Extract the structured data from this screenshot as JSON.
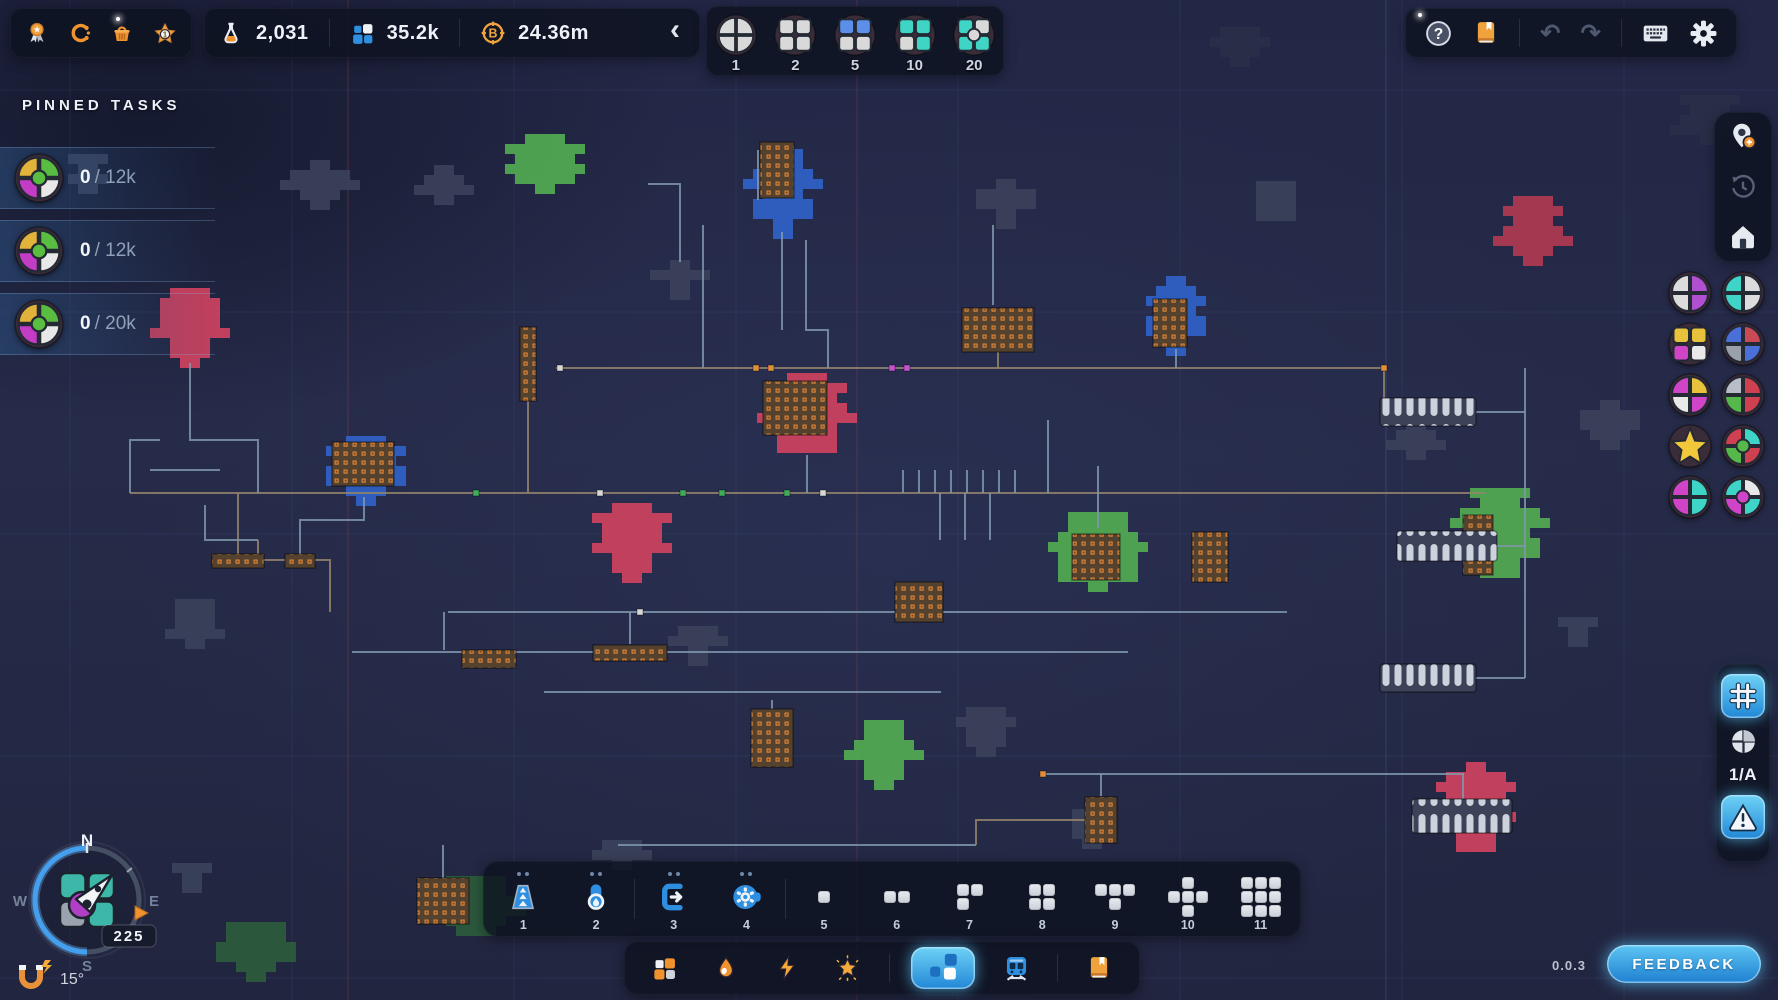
{
  "app": {
    "version": "0.0.3",
    "feedback_label": "FEEDBACK"
  },
  "topbar": {
    "left_menu": {
      "badge_value": "1"
    },
    "resources": [
      {
        "name": "research",
        "value": "2,031"
      },
      {
        "name": "shapes",
        "value": "35.2k"
      },
      {
        "name": "currency",
        "value": "24.36m"
      }
    ],
    "collapse_icon": "‹",
    "throughput_selector": {
      "options": [
        {
          "label": "1"
        },
        {
          "label": "2"
        },
        {
          "label": "5"
        },
        {
          "label": "10"
        },
        {
          "label": "20"
        }
      ]
    },
    "right_menu": {
      "help": "?",
      "undo": "↶",
      "redo": "↷"
    }
  },
  "pinned_tasks": {
    "title": "PINNED TASKS",
    "tasks": [
      {
        "current": "0",
        "sep": "/",
        "target": "12k"
      },
      {
        "current": "0",
        "sep": "/",
        "target": "12k"
      },
      {
        "current": "0",
        "sep": "/",
        "target": "20k"
      }
    ]
  },
  "sidebar_right": {
    "zone_label": "1/A"
  },
  "toolbar": {
    "items": [
      {
        "label": "1",
        "icon": "belt-icon",
        "pips": 2
      },
      {
        "label": "2",
        "icon": "pipe-icon",
        "pips": 2
      },
      {
        "label": "3",
        "icon": "extractor-icon",
        "pips": 2
      },
      {
        "label": "4",
        "icon": "processor-icon",
        "pips": 2
      },
      {
        "label": "5",
        "grid": [
          "1"
        ]
      },
      {
        "label": "6",
        "grid": [
          "11"
        ]
      },
      {
        "label": "7",
        "grid": [
          "11",
          "10"
        ]
      },
      {
        "label": "8",
        "grid": [
          "11",
          "11"
        ]
      },
      {
        "label": "9",
        "grid": [
          "111",
          "010"
        ]
      },
      {
        "label": "10",
        "grid": [
          "010",
          "111",
          "010"
        ]
      },
      {
        "label": "11",
        "grid": [
          "111",
          "111",
          "111"
        ]
      }
    ]
  },
  "compass": {
    "north": "N",
    "south": "S",
    "west": "W",
    "east": "E",
    "heading": "225",
    "tilt": "15°"
  },
  "badges": {
    "task_icon": {
      "shape": "circle",
      "colors": [
        "#e2b33a",
        "#58bd41",
        "#c33cc6",
        "#e8e8e8"
      ],
      "inner": "#58bd41"
    },
    "selector": [
      {
        "shape": "circle",
        "colors": [
          "#d9d9d9",
          "#d9d9d9",
          "#d9d9d9",
          "#d9d9d9"
        ]
      },
      {
        "shape": "square",
        "colors": [
          "#d9d9d9",
          "#d9d9d9",
          "#d9d9d9",
          "#d9d9d9"
        ]
      },
      {
        "shape": "square",
        "colors": [
          "#5b8fe8",
          "#5b8fe8",
          "#d9d9d9",
          "#d9d9d9"
        ]
      },
      {
        "shape": "square",
        "colors": [
          "#3fd4c4",
          "#3fd4c4",
          "#d9d9d9",
          "#3fd4c4"
        ]
      },
      {
        "shape": "square",
        "colors": [
          "#3fd4c4",
          "#d9d9d9",
          "#3fd4c4",
          "#3fd4c4"
        ],
        "inner": "#d9d9d9"
      }
    ],
    "sidebar": [
      {
        "shape": "circle",
        "colors": [
          "#dcdcdc",
          "#b04fd0",
          "#dcdcdc",
          "#b04fd0"
        ]
      },
      {
        "shape": "circle",
        "colors": [
          "#3fd4c8",
          "#dcdcdc",
          "#3fd4c8",
          "#dcdcdc"
        ]
      },
      {
        "shape": "square",
        "colors": [
          "#e8c23a",
          "#e8c23a",
          "#d045c8",
          "#e8e8e8"
        ]
      },
      {
        "shape": "circle",
        "colors": [
          "#4a6fd8",
          "#c84a55",
          "#9aa0aa",
          "#4a6fd8"
        ]
      },
      {
        "shape": "circle",
        "colors": [
          "#d045c8",
          "#e8c23a",
          "#e8e8e8",
          "#d045c8"
        ]
      },
      {
        "shape": "circle",
        "colors": [
          "#b8bec8",
          "#cf4050",
          "#56b84a",
          "#cf4050"
        ]
      },
      {
        "shape": "star",
        "colors": [
          "#f0c83a"
        ]
      },
      {
        "shape": "circle",
        "colors": [
          "#cf4050",
          "#3fd4c8",
          "#56b84a",
          "#cf4050"
        ],
        "inner": "#56b84a"
      },
      {
        "shape": "circle",
        "colors": [
          "#d045c8",
          "#3fd4c8",
          "#d045c8",
          "#3fd4c8"
        ]
      },
      {
        "shape": "circle",
        "colors": [
          "#3fd4c8",
          "#e8e8e8",
          "#d045c8",
          "#3fd4c8"
        ],
        "inner": "#d045c8"
      }
    ]
  },
  "map": {
    "colors": {
      "g": "#53ab53",
      "gd": "#2c5c3c",
      "c": "#ce4260",
      "cd": "#b03a52",
      "b": "#2f62c8",
      "y": "#3b415a",
      "dk": "#2a2f49",
      "steel": "#7f96ab",
      "tan": "#94846b"
    },
    "blobs": [
      [
        545,
        160,
        38,
        26,
        "g"
      ],
      [
        1098,
        552,
        44,
        40,
        "g"
      ],
      [
        1500,
        532,
        42,
        44,
        "g"
      ],
      [
        884,
        753,
        30,
        33,
        "g"
      ],
      [
        476,
        906,
        40,
        30,
        "gd"
      ],
      [
        256,
        948,
        36,
        26,
        "gd"
      ],
      [
        190,
        325,
        34,
        37,
        "c"
      ],
      [
        807,
        413,
        42,
        40,
        "c"
      ],
      [
        632,
        540,
        35,
        37,
        "c"
      ],
      [
        1476,
        806,
        35,
        44,
        "c"
      ],
      [
        1533,
        230,
        31,
        34,
        "cd"
      ],
      [
        783,
        190,
        31,
        41,
        "b"
      ],
      [
        1176,
        313,
        29,
        37,
        "b"
      ],
      [
        366,
        467,
        39,
        31,
        "b"
      ],
      [
        320,
        183,
        29,
        23,
        "y"
      ],
      [
        444,
        184,
        23,
        19,
        "y"
      ],
      [
        680,
        277,
        21,
        17,
        "y"
      ],
      [
        1006,
        200,
        27,
        21,
        "y"
      ],
      [
        1276,
        200,
        25,
        19,
        "y"
      ],
      [
        195,
        620,
        25,
        21,
        "y"
      ],
      [
        698,
        645,
        23,
        19,
        "y"
      ],
      [
        986,
        728,
        25,
        21,
        "y"
      ],
      [
        1610,
        423,
        27,
        23,
        "y"
      ],
      [
        1416,
        437,
        21,
        17,
        "y"
      ],
      [
        1092,
        826,
        23,
        17,
        "y"
      ],
      [
        192,
        876,
        17,
        13,
        "y"
      ],
      [
        622,
        855,
        21,
        15,
        "y"
      ],
      [
        88,
        170,
        20,
        16,
        "y"
      ],
      [
        1578,
        628,
        14,
        11,
        "y"
      ],
      [
        1710,
        120,
        31,
        25,
        "dk"
      ],
      [
        1240,
        45,
        25,
        18,
        "dk"
      ]
    ],
    "machines": [
      [
        777,
        170,
        34,
        56
      ],
      [
        998,
        330,
        72,
        44
      ],
      [
        1170,
        323,
        34,
        48
      ],
      [
        363,
        464,
        62,
        44
      ],
      [
        795,
        408,
        64,
        54
      ],
      [
        528,
        364,
        16,
        74
      ],
      [
        919,
        602,
        48,
        40
      ],
      [
        1096,
        557,
        48,
        46
      ],
      [
        1210,
        557,
        36,
        50
      ],
      [
        772,
        738,
        42,
        58
      ],
      [
        1101,
        820,
        32,
        46
      ],
      [
        630,
        653,
        74,
        16
      ],
      [
        489,
        659,
        54,
        18
      ],
      [
        443,
        901,
        52,
        46
      ],
      [
        1478,
        545,
        30,
        60
      ],
      [
        238,
        561,
        52,
        14
      ],
      [
        300,
        561,
        30,
        14
      ]
    ],
    "pill_rows": [
      [
        1428,
        412,
        96,
        28
      ],
      [
        1447,
        546,
        100,
        30
      ],
      [
        1428,
        678,
        96,
        28
      ],
      [
        1462,
        816,
        100,
        34
      ]
    ],
    "lines": [
      {
        "c": "t",
        "d": "M556,368 H1384"
      },
      {
        "c": "t",
        "d": "M130,493 H1486"
      },
      {
        "c": "s",
        "d": "M448,612 H1287"
      },
      {
        "c": "s",
        "d": "M352,652 H1128"
      },
      {
        "c": "s",
        "d": "M544,692 H941"
      },
      {
        "c": "s",
        "d": "M1043,774 H1464"
      },
      {
        "c": "s",
        "d": "M618,845 H976"
      },
      {
        "c": "s",
        "d": "M703,225 V368"
      },
      {
        "c": "s",
        "d": "M758,150 V200"
      },
      {
        "c": "s",
        "d": "M782,232 V330"
      },
      {
        "c": "s",
        "d": "M806,240 V330 H828 V368"
      },
      {
        "c": "s",
        "d": "M648,184 H680 V262"
      },
      {
        "c": "s",
        "d": "M993,225 V305"
      },
      {
        "c": "t",
        "d": "M998,352 V368"
      },
      {
        "c": "s",
        "d": "M1176,349 V368"
      },
      {
        "c": "s",
        "d": "M1048,420 V493"
      },
      {
        "c": "s",
        "d": "M1098,466 V528"
      },
      {
        "c": "s",
        "d": "M807,455 V493"
      },
      {
        "c": "t",
        "d": "M528,401 V493"
      },
      {
        "c": "s",
        "d": "M364,497 V520 H300 V560"
      },
      {
        "c": "s",
        "d": "M190,363 V440 H258 V493"
      },
      {
        "c": "t",
        "d": "M238,493 V560 H330 V612"
      },
      {
        "c": "s",
        "d": "M160,440 H130 V493"
      },
      {
        "c": "s",
        "d": "M444,612 V650"
      },
      {
        "c": "s",
        "d": "M630,612 V644"
      },
      {
        "c": "s",
        "d": "M919,612 V622"
      },
      {
        "c": "s",
        "d": "M772,700 V710"
      },
      {
        "c": "s",
        "d": "M1101,774 V796"
      },
      {
        "c": "s",
        "d": "M1525,368 V678"
      },
      {
        "c": "s",
        "d": "M1476,412 H1525"
      },
      {
        "c": "s",
        "d": "M1497,546 H1525"
      },
      {
        "c": "s",
        "d": "M1476,678 H1525"
      },
      {
        "c": "s",
        "d": "M1463,774 V800"
      },
      {
        "c": "t",
        "d": "M1384,368 V412 H1476"
      },
      {
        "c": "s",
        "d": "M443,845 V878"
      },
      {
        "c": "t",
        "d": "M976,845 V820 H1086"
      },
      {
        "c": "s",
        "d": "M903,470 V493"
      },
      {
        "c": "s",
        "d": "M919,470 V493"
      },
      {
        "c": "s",
        "d": "M935,470 V493"
      },
      {
        "c": "s",
        "d": "M951,470 V493"
      },
      {
        "c": "s",
        "d": "M967,470 V493"
      },
      {
        "c": "s",
        "d": "M983,470 V493"
      },
      {
        "c": "s",
        "d": "M999,470 V493"
      },
      {
        "c": "s",
        "d": "M1015,470 V493"
      },
      {
        "c": "s",
        "d": "M940,493 V540"
      },
      {
        "c": "s",
        "d": "M965,493 V540"
      },
      {
        "c": "s",
        "d": "M990,493 V540"
      },
      {
        "c": "s",
        "d": "M205,505 V540 H258"
      },
      {
        "c": "s",
        "d": "M150,470 H220"
      },
      {
        "c": "t",
        "d": "M258,540 V560"
      }
    ],
    "nodes": [
      [
        683,
        493,
        "#3fae5a"
      ],
      [
        722,
        493,
        "#3fae5a"
      ],
      [
        787,
        493,
        "#3fae5a"
      ],
      [
        823,
        493,
        "#d8d8d8"
      ],
      [
        892,
        368,
        "#c94fd4"
      ],
      [
        907,
        368,
        "#c94fd4"
      ],
      [
        756,
        368,
        "#e0903a"
      ],
      [
        771,
        368,
        "#e0903a"
      ],
      [
        560,
        368,
        "#d8d8d8"
      ],
      [
        600,
        493,
        "#d8d8d8"
      ],
      [
        1384,
        368,
        "#e0903a"
      ],
      [
        640,
        612,
        "#d8d8d8"
      ],
      [
        1043,
        774,
        "#e0903a"
      ],
      [
        476,
        493,
        "#3fae5a"
      ]
    ]
  }
}
